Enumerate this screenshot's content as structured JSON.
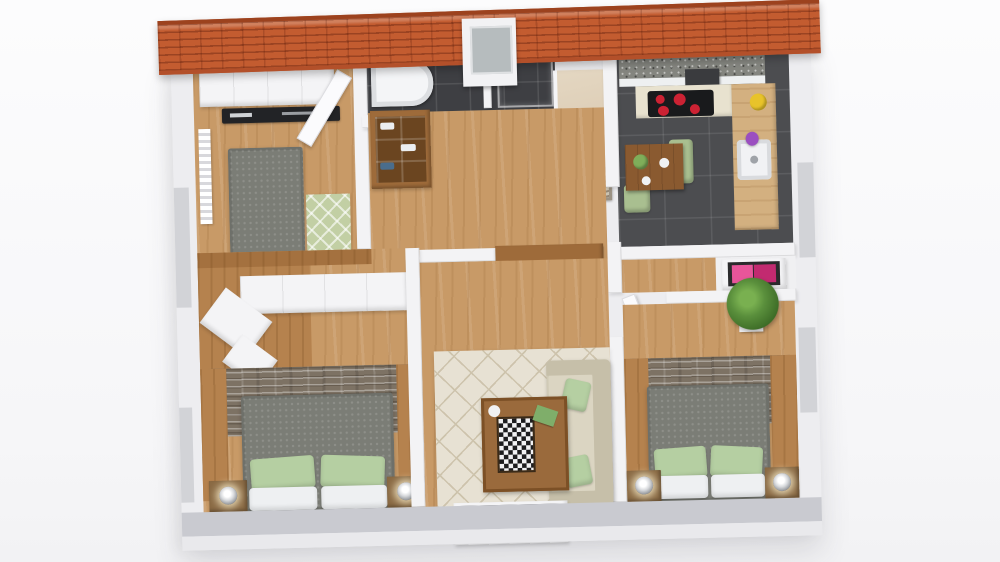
{
  "scene": {
    "type": "3d-floor-plan",
    "view": "top-down isometric render of a single-storey apartment with orange tiled roof edge at top",
    "rooms": [
      {
        "id": "bedroom-top-left",
        "name": "Bedroom (top left)",
        "items": [
          "built-in white wardrobe",
          "black TV sideboard",
          "double bed with grey duvet and white pillows",
          "green patterned rug",
          "wall radiator",
          "open door"
        ]
      },
      {
        "id": "bathroom",
        "name": "Bathroom",
        "items": [
          "dark grey wall tiles",
          "white bathtub",
          "glass walk-in shower",
          "roof skylight window"
        ]
      },
      {
        "id": "staircase",
        "name": "Staircase",
        "items": [
          "beige stair ramp",
          "three stone step treads"
        ]
      },
      {
        "id": "kitchen",
        "name": "Kitchen / Dining",
        "items": [
          "granite worktop strip",
          "hob with four red burners",
          "coffee machine",
          "white sink",
          "yellow fruit bowl",
          "purple flowers",
          "dark wood dining table with plates and salad bowl",
          "two green chairs",
          "dark grey tile floor"
        ]
      },
      {
        "id": "hallway",
        "name": "Hallway",
        "items": [
          "open shelf unit with linens",
          "wide wooden sideboard shelf with books",
          "interior doors"
        ]
      },
      {
        "id": "dressing-area",
        "name": "Dressing area",
        "items": [
          "L-shaped wardrobe with white tops",
          "dark wood platform floor"
        ]
      },
      {
        "id": "bedroom-bottom-left",
        "name": "Bedroom (bottom left)",
        "items": [
          "stone accent wall panel",
          "double bed with grey duvet",
          "two green pillows",
          "two white pillows",
          "two nightstands with glowing lamps"
        ]
      },
      {
        "id": "living-room",
        "name": "Living room",
        "items": [
          "beige lattice area rug",
          "beige sofa with two green cushions",
          "wooden coffee table with chessboard",
          "white TV console with dark top"
        ]
      },
      {
        "id": "bedroom-bottom-right",
        "name": "Bedroom (bottom right)",
        "items": [
          "potted green plant",
          "white dresser with pink top in dark frame",
          "stone accent wall panel",
          "double bed with grey duvet",
          "two green pillows",
          "two white pillows",
          "two nightstands with glowing lamps"
        ]
      }
    ]
  },
  "colors": {
    "roof_orange": "#c35c30",
    "wood_floor": "#c89a67",
    "wood_dark": "#b5824e",
    "bath_tile": "#3e3f43",
    "kitchen_tile": "#4c4d50",
    "stone_wall": "#7d7264",
    "rug_living": "#e7e1d3",
    "rug_lattice": "#cdc3ac",
    "rug_green": "#c2cfa4",
    "bed_gray": "#7b7d76",
    "pillow_green": "#b5cfa2",
    "sofa_beige": "#d0cab6",
    "chair_green": "#a9bf90",
    "shelf_wood": "#9e6b3a",
    "nightstand": "#8a6a44",
    "pink_left": "#e8559a",
    "pink_right": "#c22a70",
    "plant_green": "#5a8f3c",
    "burner_red": "#cc2233"
  }
}
